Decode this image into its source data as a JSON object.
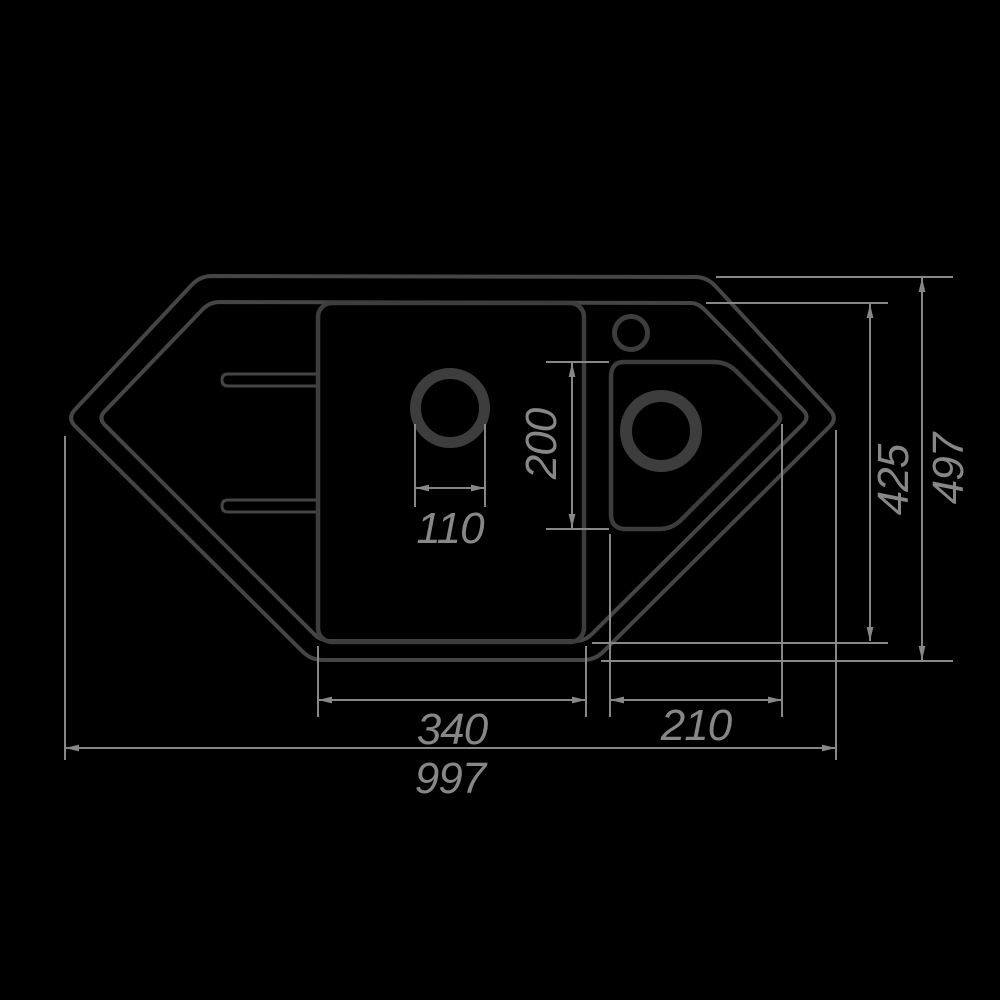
{
  "drawing": {
    "title": "corner-sink-top-view-dimension-drawing",
    "background": "#000000",
    "colors": {
      "background": "#000000",
      "outline": "#454545",
      "bowl": "#3d3d3d",
      "dimension": "#878787"
    },
    "features": {
      "outer_outline": "sink outer edge (elongated hexagon with left and right points)",
      "inner_rim": "inner rim line parallel to outer edge",
      "main_bowl": "large rectangular main bowl with drain hole",
      "small_bowl": "small pentagonal right bowl with drain hole",
      "tap_hole": "round tap hole above small bowl",
      "drainer_grooves": "two drainer grooves on left wing"
    },
    "dimensions": {
      "total_width": {
        "value": "997",
        "orientation": "horizontal",
        "measures": "overall width, point to point"
      },
      "total_depth": {
        "value": "497",
        "orientation": "vertical",
        "measures": "overall depth, outer edge"
      },
      "inner_depth": {
        "value": "425",
        "orientation": "vertical",
        "measures": "depth of inner rim"
      },
      "main_bowl_width": {
        "value": "340",
        "orientation": "horizontal",
        "measures": "main bowl width"
      },
      "small_bowl_width": {
        "value": "210",
        "orientation": "horizontal",
        "measures": "small bowl width to point"
      },
      "small_bowl_depth": {
        "value": "200",
        "orientation": "vertical",
        "measures": "small bowl depth"
      },
      "drain_diameter": {
        "value": "110",
        "orientation": "horizontal",
        "measures": "main drain hole diameter"
      }
    }
  }
}
